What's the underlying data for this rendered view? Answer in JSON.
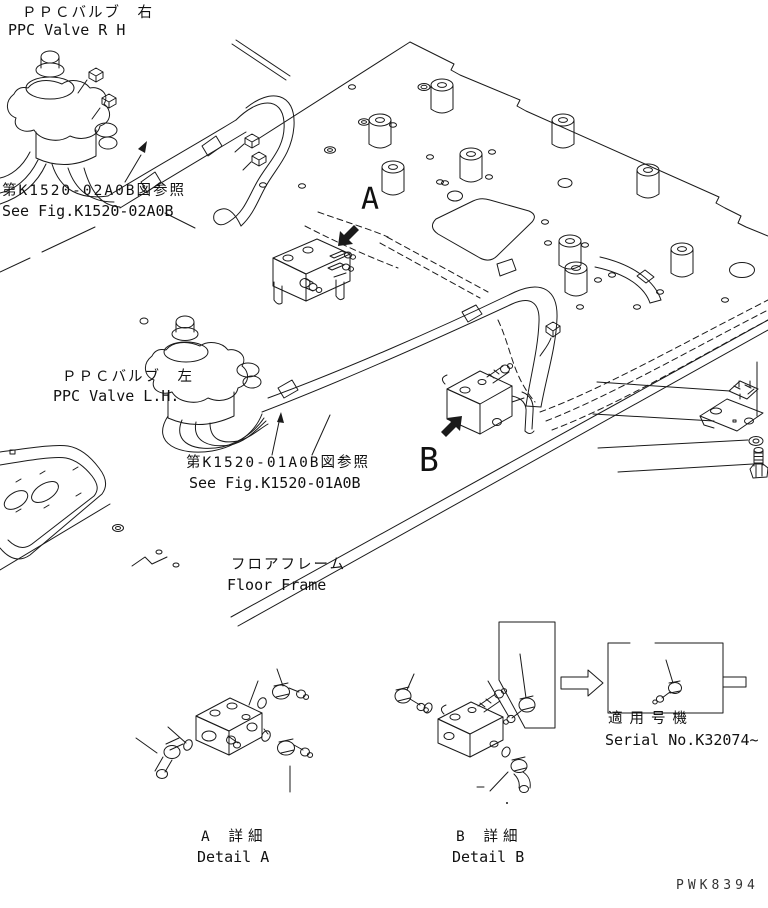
{
  "page": {
    "background": "#ffffff",
    "line_color": "#1a1a1a",
    "type": "parts-piping-line-drawing"
  },
  "labels": {
    "ppc_valve_rh": {
      "jp": "ＰＰＣバルブ　右",
      "en": "PPC Valve R H"
    },
    "ref_fig_rh": {
      "jp": "第K1520-02A0B図参照",
      "en": "See Fig.K1520-02A0B"
    },
    "ppc_valve_lh": {
      "jp": "ＰＰＣバルブ　左",
      "en": "PPC Valve L.H."
    },
    "ref_fig_lh": {
      "jp": "第K1520-01A0B図参照",
      "en": "See Fig.K1520-01A0B"
    },
    "floor_frame": {
      "jp": "フロアフレーム",
      "en": "Floor Frame"
    },
    "serial": {
      "jp": "適用号機",
      "en": "Serial No.K32074~"
    },
    "detail_a": {
      "jp": "A 詳細",
      "en": "Detail A"
    },
    "detail_b": {
      "jp": "B 詳細",
      "en": "Detail B"
    },
    "marker_a": "A",
    "marker_b": "B",
    "doc_code": "PWK8394"
  }
}
